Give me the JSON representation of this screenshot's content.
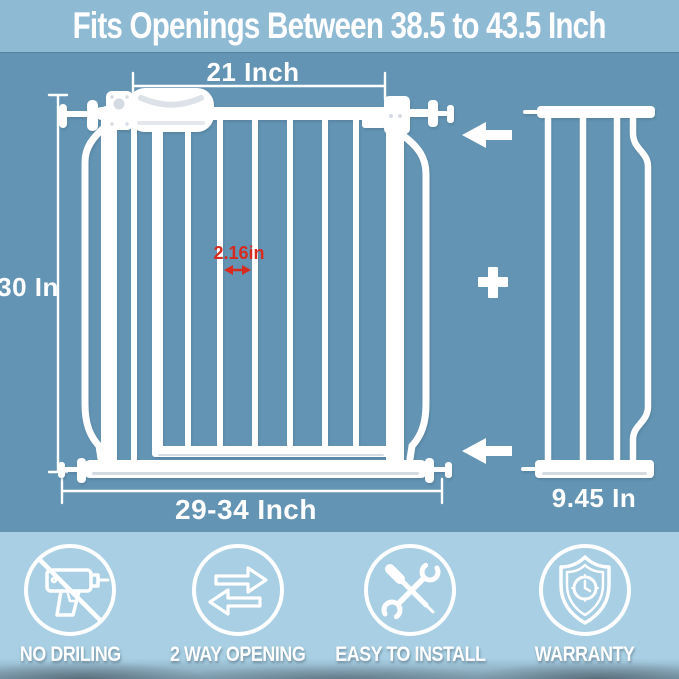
{
  "title": "Fits Openings Between 38.5 to 43.5 Inch",
  "colors": {
    "bg_main": "#6394b4",
    "bg_title_band": "#8fbad4",
    "bg_feature_band": "#a8cfe3",
    "gate_white": "#ffffff",
    "shade_gray": "#d5dbe2",
    "red_annotation": "#d62b1e"
  },
  "diagram": {
    "gate": {
      "top_width_label": "21 Inch",
      "height_label": "30 In",
      "bar_gap_label": "2.16in",
      "bottom_width_label": "29-34 Inch"
    },
    "extension": {
      "width_label": "9.45 In"
    },
    "annotations": {
      "upper_arrow_icon": "left-arrow-icon",
      "lower_arrow_icon": "left-arrow-icon",
      "plus_icon": "plus-icon",
      "gap_arrow_icon": "double-arrow-icon"
    }
  },
  "features": [
    {
      "icon": "no-drilling-icon",
      "label": "NO DRILING"
    },
    {
      "icon": "two-way-opening-icon",
      "label": "2 WAY OPENING"
    },
    {
      "icon": "easy-to-install-icon",
      "label": "EASY TO INSTALL"
    },
    {
      "icon": "warranty-icon",
      "label": "WARRANTY"
    }
  ]
}
